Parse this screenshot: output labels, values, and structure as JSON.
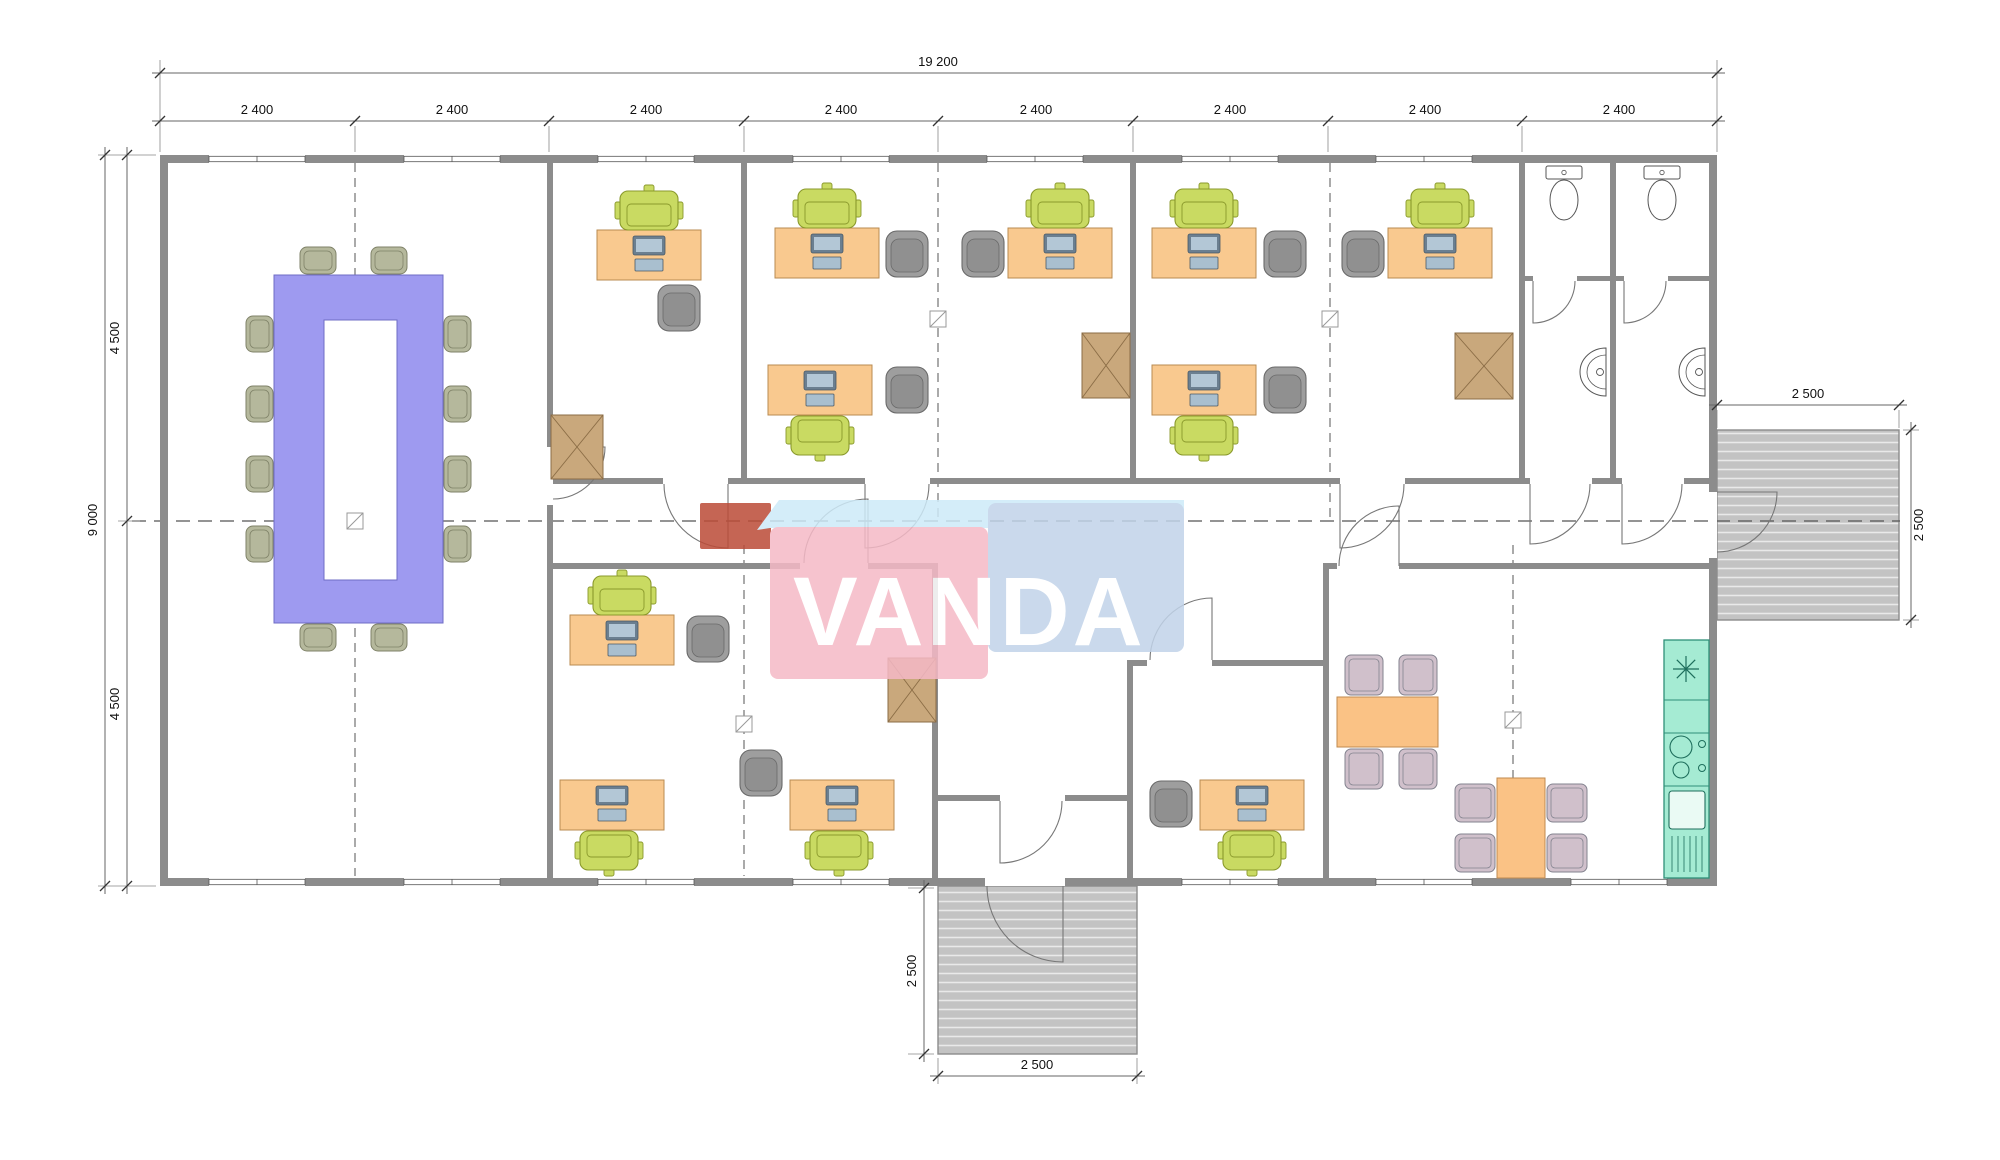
{
  "watermark": {
    "text": "VANDA",
    "text_x": 793,
    "text_y": 645,
    "font_size": 97,
    "letter_spacing": 3,
    "band_points": "757,530 779,500 1184,500 1184,528 770,528",
    "pink_rect": [
      770,
      527,
      218,
      152
    ],
    "blue_rect": [
      988,
      503,
      196,
      149
    ],
    "red_rect": [
      700,
      503,
      71,
      46
    ],
    "colors": {
      "pink": "#f5b9c6",
      "blue": "#c1d3e9",
      "light_blue": "#cdeaf8",
      "red": "#bc4b37",
      "text": "#ffffff"
    },
    "opacity": 0.85
  },
  "colors": {
    "wall": "#8c8c8c",
    "floor": "#ffffff",
    "dim_line": "#666666",
    "dim_text": "#111111",
    "ext_line": "#888888",
    "axis": "#555555",
    "door": "#777777",
    "desk": "#f9c98f",
    "desk_stroke": "#b98b52",
    "task_chair": "#c9da62",
    "task_chair_stroke": "#8a992c",
    "armchair": "#9e9e9e",
    "armchair_stroke": "#6a6a6a",
    "conf_table": "#9e9af0",
    "conf_table_stroke": "#6f6cc4",
    "conf_chair": "#b5b89c",
    "conf_chair_stroke": "#7f8268",
    "cabinet": "#c9a87c",
    "cabinet_stroke": "#8b6d46",
    "dining_table": "#fac285",
    "dining_table_stroke": "#c08a4e",
    "dining_chair": "#d0c0cb",
    "dining_chair_stroke": "#83838f",
    "kitchen": "#a5ebd3",
    "kitchen_stroke": "#2f8f78",
    "kitchen_icon": "#1e6e5c",
    "fixture_stroke": "#555555",
    "pc_dark": "#6b7f90",
    "pc_screen": "#b3c7d6",
    "pc_kb": "#a9bfcf",
    "pc_stroke": "#4a5a66",
    "marker_stroke": "#999999"
  },
  "plan": {
    "floor": [
      160,
      155,
      1557,
      731
    ],
    "walls": [
      [
        160,
        155,
        1557,
        8
      ],
      [
        160,
        878,
        1557,
        8
      ],
      [
        160,
        155,
        8,
        731
      ],
      [
        1709,
        155,
        8,
        337
      ],
      [
        1709,
        558,
        8,
        328
      ],
      [
        547,
        163,
        6,
        284
      ],
      [
        547,
        505,
        6,
        373
      ],
      [
        741,
        163,
        6,
        315
      ],
      [
        1130,
        163,
        6,
        315
      ],
      [
        1519,
        163,
        6,
        315
      ],
      [
        1610,
        163,
        6,
        315
      ],
      [
        1525,
        276,
        8,
        5
      ],
      [
        1577,
        276,
        33,
        5
      ],
      [
        1616,
        276,
        8,
        5
      ],
      [
        1668,
        276,
        41,
        5
      ],
      [
        553,
        478,
        110,
        6
      ],
      [
        728,
        478,
        137,
        6
      ],
      [
        930,
        478,
        410,
        6
      ],
      [
        1405,
        478,
        125,
        6
      ],
      [
        1592,
        478,
        30,
        6
      ],
      [
        1684,
        478,
        25,
        6
      ],
      [
        553,
        563,
        247,
        6
      ],
      [
        868,
        563,
        64,
        6
      ],
      [
        932,
        563,
        6,
        315
      ],
      [
        938,
        795,
        62,
        6
      ],
      [
        1065,
        795,
        62,
        6
      ],
      [
        1127,
        660,
        6,
        218
      ],
      [
        1133,
        660,
        14,
        6
      ],
      [
        1212,
        660,
        111,
        6
      ],
      [
        1323,
        563,
        6,
        315
      ],
      [
        1329,
        563,
        8,
        6
      ],
      [
        1399,
        563,
        310,
        6
      ]
    ],
    "windows_top": [
      [
        209,
        155
      ],
      [
        404,
        155
      ],
      [
        598,
        155
      ],
      [
        793,
        155
      ],
      [
        987,
        155
      ],
      [
        1182,
        155
      ],
      [
        1376,
        155
      ]
    ],
    "windows_bottom": [
      [
        209,
        878
      ],
      [
        404,
        878
      ],
      [
        598,
        878
      ],
      [
        793,
        878
      ],
      [
        1182,
        878
      ],
      [
        1376,
        878
      ],
      [
        1571,
        878
      ]
    ],
    "window_size": [
      96,
      8
    ],
    "openings": [
      [
        985,
        878,
        80,
        8
      ],
      [
        1709,
        492,
        8,
        66
      ]
    ],
    "doors": [
      {
        "h": [
          553,
          447
        ],
        "r": 52,
        "leaf": 0,
        "jamb": 90
      },
      {
        "h": [
          728,
          484
        ],
        "r": 64,
        "leaf": 90,
        "jamb": 180
      },
      {
        "h": [
          865,
          484
        ],
        "r": 64,
        "leaf": 90,
        "jamb": 0
      },
      {
        "h": [
          1340,
          484
        ],
        "r": 64,
        "leaf": 90,
        "jamb": 0
      },
      {
        "h": [
          1530,
          484
        ],
        "r": 60,
        "leaf": 90,
        "jamb": 0
      },
      {
        "h": [
          1622,
          484
        ],
        "r": 60,
        "leaf": 90,
        "jamb": 0
      },
      {
        "h": [
          1533,
          281
        ],
        "r": 42,
        "leaf": 90,
        "jamb": 0
      },
      {
        "h": [
          1624,
          281
        ],
        "r": 42,
        "leaf": 90,
        "jamb": 0
      },
      {
        "h": [
          868,
          563
        ],
        "r": 64,
        "leaf": 270,
        "jamb": 180
      },
      {
        "h": [
          1212,
          660
        ],
        "r": 62,
        "leaf": 270,
        "jamb": 180
      },
      {
        "h": [
          1399,
          566
        ],
        "r": 60,
        "leaf": 270,
        "jamb": 180
      },
      {
        "h": [
          1000,
          801
        ],
        "r": 62,
        "leaf": 90,
        "jamb": 0
      },
      {
        "h": [
          1063,
          886
        ],
        "r": 76,
        "leaf": 90,
        "jamb": 180
      },
      {
        "h": [
          1717,
          492
        ],
        "r": 60,
        "leaf": 0,
        "jamb": 90
      }
    ],
    "axes": [
      {
        "line": [
          355,
          163,
          355,
          876
        ],
        "center": false
      },
      {
        "line": [
          744,
          545,
          744,
          876
        ],
        "center": false
      },
      {
        "line": [
          938,
          163,
          938,
          519
        ],
        "center": false
      },
      {
        "line": [
          1330,
          163,
          1330,
          519
        ],
        "center": false
      },
      {
        "line": [
          1513,
          545,
          1513,
          876
        ],
        "center": false
      },
      {
        "line": [
          132,
          521,
          1900,
          521
        ],
        "center": true
      }
    ],
    "markers": [
      [
        355,
        521
      ],
      [
        938,
        319
      ],
      [
        1330,
        319
      ],
      [
        744,
        724
      ],
      [
        1513,
        720
      ]
    ],
    "conference": {
      "table": [
        274,
        275,
        169,
        348
      ],
      "hole": [
        324,
        320,
        73,
        260
      ],
      "chairs": [
        [
          300,
          247,
          36,
          27
        ],
        [
          371,
          247,
          36,
          27
        ],
        [
          300,
          624,
          36,
          27
        ],
        [
          371,
          624,
          36,
          27
        ],
        [
          246,
          316,
          27,
          36
        ],
        [
          246,
          386,
          27,
          36
        ],
        [
          246,
          456,
          27,
          36
        ],
        [
          246,
          526,
          27,
          36
        ],
        [
          444,
          316,
          27,
          36
        ],
        [
          444,
          386,
          27,
          36
        ],
        [
          444,
          456,
          27,
          36
        ],
        [
          444,
          526,
          27,
          36
        ]
      ]
    },
    "desks": [
      [
        597,
        230
      ],
      [
        775,
        228
      ],
      [
        768,
        365
      ],
      [
        1008,
        228
      ],
      [
        1152,
        228
      ],
      [
        1152,
        365
      ],
      [
        1388,
        228
      ],
      [
        570,
        615
      ],
      [
        560,
        780
      ],
      [
        790,
        780
      ],
      [
        1200,
        780
      ]
    ],
    "desk_size": [
      104,
      50
    ],
    "task_chairs": [
      {
        "p": [
          620,
          191
        ],
        "f": "d"
      },
      {
        "p": [
          798,
          189
        ],
        "f": "d"
      },
      {
        "p": [
          1031,
          189
        ],
        "f": "d"
      },
      {
        "p": [
          1175,
          189
        ],
        "f": "d"
      },
      {
        "p": [
          1411,
          189
        ],
        "f": "d"
      },
      {
        "p": [
          593,
          576
        ],
        "f": "d"
      },
      {
        "p": [
          791,
          416
        ],
        "f": "u"
      },
      {
        "p": [
          1175,
          416
        ],
        "f": "u"
      },
      {
        "p": [
          580,
          831
        ],
        "f": "u"
      },
      {
        "p": [
          810,
          831
        ],
        "f": "u"
      },
      {
        "p": [
          1223,
          831
        ],
        "f": "u"
      }
    ],
    "armchairs": [
      [
        658,
        285
      ],
      [
        886,
        231
      ],
      [
        886,
        367
      ],
      [
        962,
        231
      ],
      [
        1264,
        231
      ],
      [
        1264,
        367
      ],
      [
        1342,
        231
      ],
      [
        687,
        616
      ],
      [
        740,
        750
      ],
      [
        1150,
        781
      ]
    ],
    "cabinets": [
      [
        551,
        415,
        52,
        64
      ],
      [
        1082,
        333,
        48,
        65
      ],
      [
        1455,
        333,
        58,
        66
      ],
      [
        888,
        658,
        48,
        64
      ]
    ],
    "dining_tables": [
      [
        1337,
        697,
        101,
        50
      ],
      [
        1497,
        778,
        48,
        100
      ]
    ],
    "dining_chairs": [
      [
        1345,
        655,
        38,
        40
      ],
      [
        1399,
        655,
        38,
        40
      ],
      [
        1345,
        749,
        38,
        40
      ],
      [
        1399,
        749,
        38,
        40
      ],
      [
        1455,
        784,
        40,
        38
      ],
      [
        1455,
        834,
        40,
        38
      ],
      [
        1547,
        784,
        40,
        38
      ],
      [
        1547,
        834,
        40,
        38
      ]
    ],
    "toilets": [
      [
        1546,
        166
      ],
      [
        1644,
        166
      ]
    ],
    "sinks": [
      [
        1606,
        348
      ],
      [
        1705,
        348
      ]
    ],
    "kitchen": {
      "rect": [
        1664,
        640,
        45,
        238
      ],
      "dividers": [
        700,
        733,
        786
      ],
      "star": [
        1686,
        669
      ],
      "burners": [
        [
          1681,
          747,
          11
        ],
        [
          1681,
          770,
          8
        ]
      ],
      "knobs": [
        [
          1702,
          744,
          3.5
        ],
        [
          1702,
          768,
          3.5
        ]
      ],
      "fridge": [
        1669,
        791,
        36,
        38
      ],
      "vents_y": [
        836,
        872
      ]
    },
    "stairs": [
      [
        1717,
        430,
        182,
        190
      ],
      [
        938,
        886,
        199,
        168
      ]
    ]
  },
  "dimensions": [
    {
      "line": [
        152,
        73,
        1725,
        73
      ],
      "ticks": [
        [
          160,
          73
        ],
        [
          1717,
          73
        ]
      ],
      "texts": [
        {
          "t": "19 200",
          "x": 938,
          "y": 66,
          "rot": false
        }
      ]
    },
    {
      "line": [
        152,
        121,
        1725,
        121
      ],
      "ticks": [
        [
          160,
          121
        ],
        [
          355,
          121
        ],
        [
          549,
          121
        ],
        [
          744,
          121
        ],
        [
          938,
          121
        ],
        [
          1133,
          121
        ],
        [
          1328,
          121
        ],
        [
          1522,
          121
        ],
        [
          1717,
          121
        ]
      ],
      "texts": [
        {
          "t": "2 400",
          "x": 257,
          "y": 114,
          "rot": false
        },
        {
          "t": "2 400",
          "x": 452,
          "y": 114,
          "rot": false
        },
        {
          "t": "2 400",
          "x": 646,
          "y": 114,
          "rot": false
        },
        {
          "t": "2 400",
          "x": 841,
          "y": 114,
          "rot": false
        },
        {
          "t": "2 400",
          "x": 1036,
          "y": 114,
          "rot": false
        },
        {
          "t": "2 400",
          "x": 1230,
          "y": 114,
          "rot": false
        },
        {
          "t": "2 400",
          "x": 1425,
          "y": 114,
          "rot": false
        },
        {
          "t": "2 400",
          "x": 1619,
          "y": 114,
          "rot": false
        }
      ]
    },
    {
      "line": [
        105,
        147,
        105,
        894
      ],
      "ticks": [
        [
          105,
          155
        ],
        [
          105,
          886
        ]
      ],
      "texts": [
        {
          "t": "9 000",
          "x": 97,
          "y": 520,
          "rot": true
        }
      ]
    },
    {
      "line": [
        127,
        147,
        127,
        894
      ],
      "ticks": [
        [
          127,
          155
        ],
        [
          127,
          521
        ],
        [
          127,
          886
        ]
      ],
      "texts": [
        {
          "t": "4 500",
          "x": 119,
          "y": 338,
          "rot": true
        },
        {
          "t": "4 500",
          "x": 119,
          "y": 704,
          "rot": true
        }
      ]
    },
    {
      "line": [
        1709,
        405,
        1907,
        405
      ],
      "ticks": [
        [
          1717,
          405
        ],
        [
          1899,
          405
        ]
      ],
      "texts": [
        {
          "t": "2 500",
          "x": 1808,
          "y": 398,
          "rot": false
        }
      ]
    },
    {
      "line": [
        1911,
        422,
        1911,
        628
      ],
      "ticks": [
        [
          1911,
          430
        ],
        [
          1911,
          620
        ]
      ],
      "texts": [
        {
          "t": "2 500",
          "x": 1923,
          "y": 525,
          "rot": true
        }
      ]
    },
    {
      "line": [
        924,
        880,
        924,
        1062
      ],
      "ticks": [
        [
          924,
          888
        ],
        [
          924,
          1054
        ]
      ],
      "texts": [
        {
          "t": "2 500",
          "x": 916,
          "y": 971,
          "rot": true
        }
      ]
    },
    {
      "line": [
        930,
        1076,
        1145,
        1076
      ],
      "ticks": [
        [
          938,
          1076
        ],
        [
          1137,
          1076
        ]
      ],
      "texts": [
        {
          "t": "2 500",
          "x": 1037,
          "y": 1069,
          "rot": false
        }
      ]
    }
  ],
  "extensions": [
    [
      160,
      60,
      160,
      152
    ],
    [
      1717,
      60,
      1717,
      152
    ],
    [
      355,
      126,
      355,
      152
    ],
    [
      549,
      126,
      549,
      152
    ],
    [
      744,
      126,
      744,
      152
    ],
    [
      938,
      126,
      938,
      152
    ],
    [
      1133,
      126,
      1133,
      152
    ],
    [
      1328,
      126,
      1328,
      152
    ],
    [
      1522,
      126,
      1522,
      152
    ],
    [
      98,
      155,
      156,
      155
    ],
    [
      98,
      886,
      156,
      886
    ],
    [
      118,
      521,
      140,
      521
    ],
    [
      1717,
      410,
      1717,
      428
    ],
    [
      1899,
      410,
      1899,
      428
    ],
    [
      1903,
      430,
      1919,
      430
    ],
    [
      1903,
      620,
      1919,
      620
    ],
    [
      908,
      888,
      934,
      888
    ],
    [
      908,
      1054,
      934,
      1054
    ],
    [
      938,
      1058,
      938,
      1084
    ],
    [
      1137,
      1058,
      1137,
      1084
    ]
  ]
}
